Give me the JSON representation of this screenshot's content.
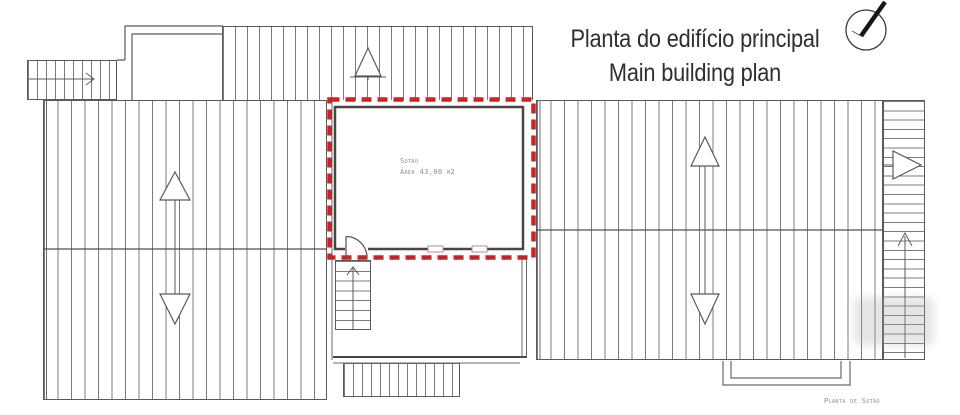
{
  "header": {
    "title_pt": "Planta do edifício principal",
    "title_en": "Main building plan"
  },
  "highlight": {
    "room_name": "Sotão",
    "room_area": "Área 43,00 m2",
    "outline_color": "#cb2127"
  },
  "caption": "Planta de Sotão",
  "icons": {
    "compass": "compass-needle-icon"
  },
  "colors": {
    "linework": "#5a5a5a",
    "hatch": "#7b7b7b",
    "text_dark": "#2e2e2e",
    "text_cad": "#8b8b8b"
  }
}
